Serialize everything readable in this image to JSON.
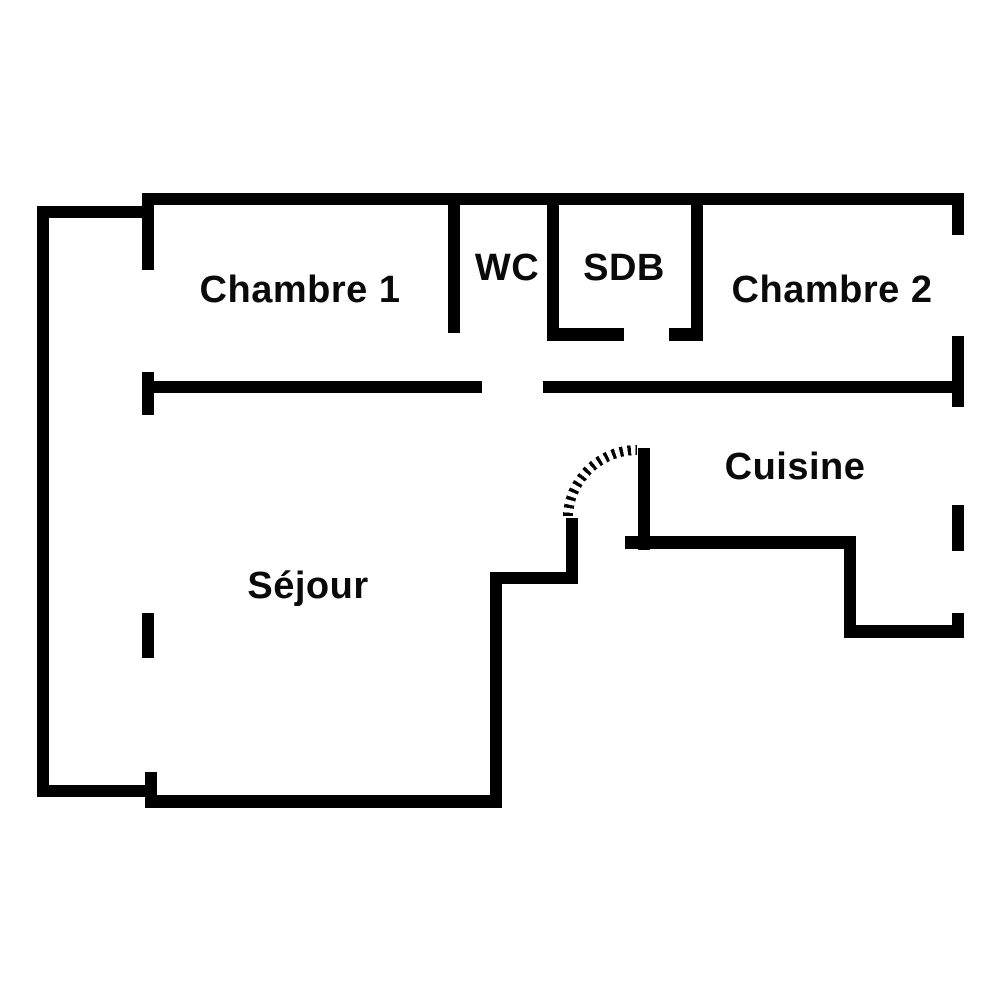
{
  "plan": {
    "type": "apartment-floor-plan",
    "rooms": [
      {
        "label": "Chambre 1"
      },
      {
        "label": "WC"
      },
      {
        "label": "SDB"
      },
      {
        "label": "Chambre 2"
      },
      {
        "label": "Cuisine"
      },
      {
        "label": "Séjour"
      }
    ],
    "colors": {
      "wall": "#000000",
      "background": "#ffffff",
      "label_text": "#0a0a0a"
    }
  }
}
